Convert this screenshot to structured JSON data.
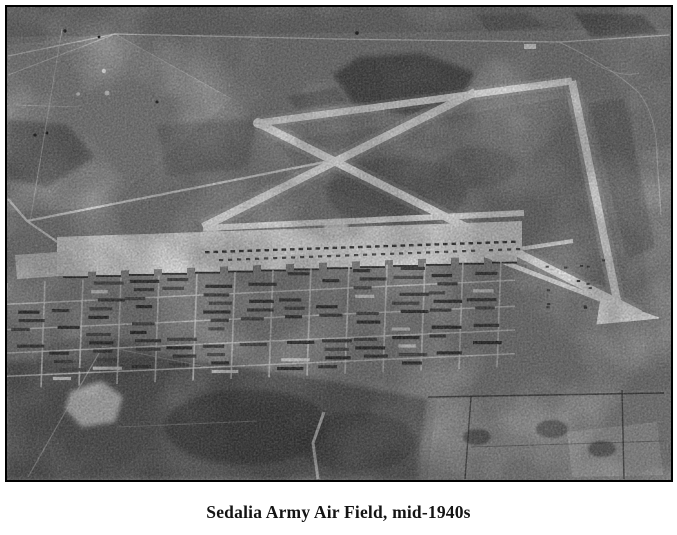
{
  "figure": {
    "type": "black-and-white aerial photograph",
    "caption": "Sedalia Army Air Field, mid-1940s"
  },
  "colors": {
    "paper": "#ffffff",
    "ink": "#141414",
    "frame": "#000000",
    "photo_base": "#8d8d8d",
    "runway": "#f3f3f3",
    "apron": "#ededed",
    "building_dark": "#343434",
    "street_light": "#dcdcdc"
  }
}
